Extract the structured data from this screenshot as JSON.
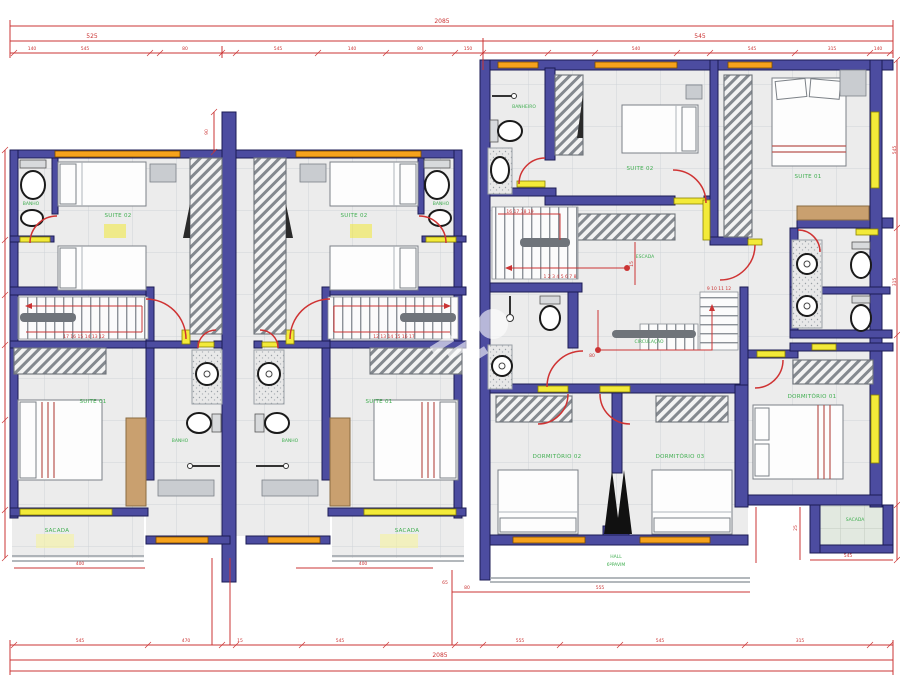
{
  "rooms": {
    "banho_top_l": "BANHO",
    "suite02_l": "SUITE 02",
    "suite01_l": "SUITE 01",
    "banho_mid_l": "BANHO",
    "sacada_l": "SACADA",
    "banho_top_r": "BANHO",
    "suite02_r": "SUITE 02",
    "suite01_r": "SUITE 01",
    "banho_mid_r": "BANHO",
    "sacada_r": "SACADA",
    "rb_banheiro": "BANHEIRO",
    "rb_suite02": "SUITE 02",
    "rb_suite01": "SUITE 01",
    "rb_escada": "ESCADA",
    "rb_circulacao": "CIRCULAÇÃO",
    "rb_dorm01": "DORMITÓRIO 01",
    "rb_dorm02": "DORMITÓRIO 02",
    "rb_dorm03": "DORMITÓRIO 03",
    "rb_sacada": "SACADA",
    "rb_hall1": "HALL",
    "rb_hall2": "6ºPAVIM"
  },
  "dimensions": {
    "overall_top": "2085",
    "overall_bottom": "2085",
    "top2": [
      "525",
      "545"
    ],
    "top3": [
      "140",
      "545",
      "80",
      "545",
      "140",
      "80",
      "150",
      "540",
      "545",
      "315",
      "140"
    ],
    "bottomA": [
      "400",
      "400",
      "555",
      "545"
    ],
    "bottom1": [
      "545",
      "470",
      "15",
      "545",
      "555",
      "545",
      "315"
    ],
    "side": [
      "545",
      "315"
    ],
    "small": [
      "90",
      "80",
      "15",
      "25",
      "80",
      "65"
    ]
  },
  "stairs": {
    "flight_l": "17 16 15 14 13 12",
    "flight_r": "12 13 14 15 16 17",
    "rb_top": "16 17 18 19",
    "rb_main": "1 2 3 4 5 6 7 8",
    "rb_up": "9 10 11 12"
  },
  "colors": {
    "wall": "#4c4ca0",
    "wall_outline": "#1b1b55",
    "dimension_red": "#cb3434",
    "window_orange": "#f6a21c",
    "window_yellow": "#f3ea39",
    "label_green": "#3fae4f",
    "closet_tan": "#c9a06f",
    "floor": "#ececec"
  }
}
